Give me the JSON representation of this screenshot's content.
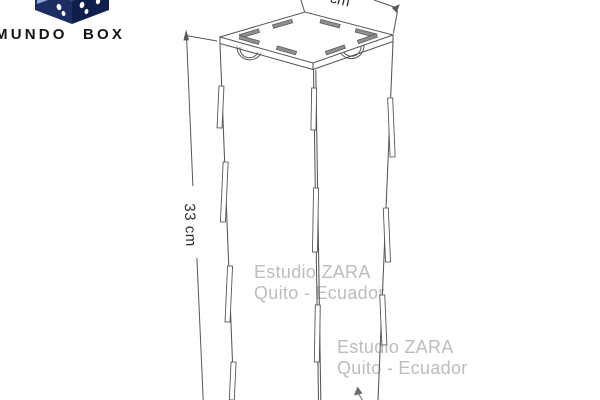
{
  "page": {
    "width": 600,
    "height": 400,
    "background": "#ffffff"
  },
  "logo": {
    "brand": "MUNDO BOX",
    "icon": "cube-with-footprints",
    "colors": {
      "left_face": "#1c2d63",
      "right_face": "#0f1f4c",
      "top_face": "#2a3d76",
      "accent": "#93a9d4",
      "text": "#141414"
    }
  },
  "drawing": {
    "line_color": "#565656",
    "slot_fill": "#8f8f8f"
  },
  "dimensions": {
    "height_label": "33 cm",
    "top_width_label": "cm"
  },
  "watermark": {
    "line1": "Estudio ZARA",
    "line2": "Quito - Ecuador",
    "color": "#bdbdbd"
  }
}
